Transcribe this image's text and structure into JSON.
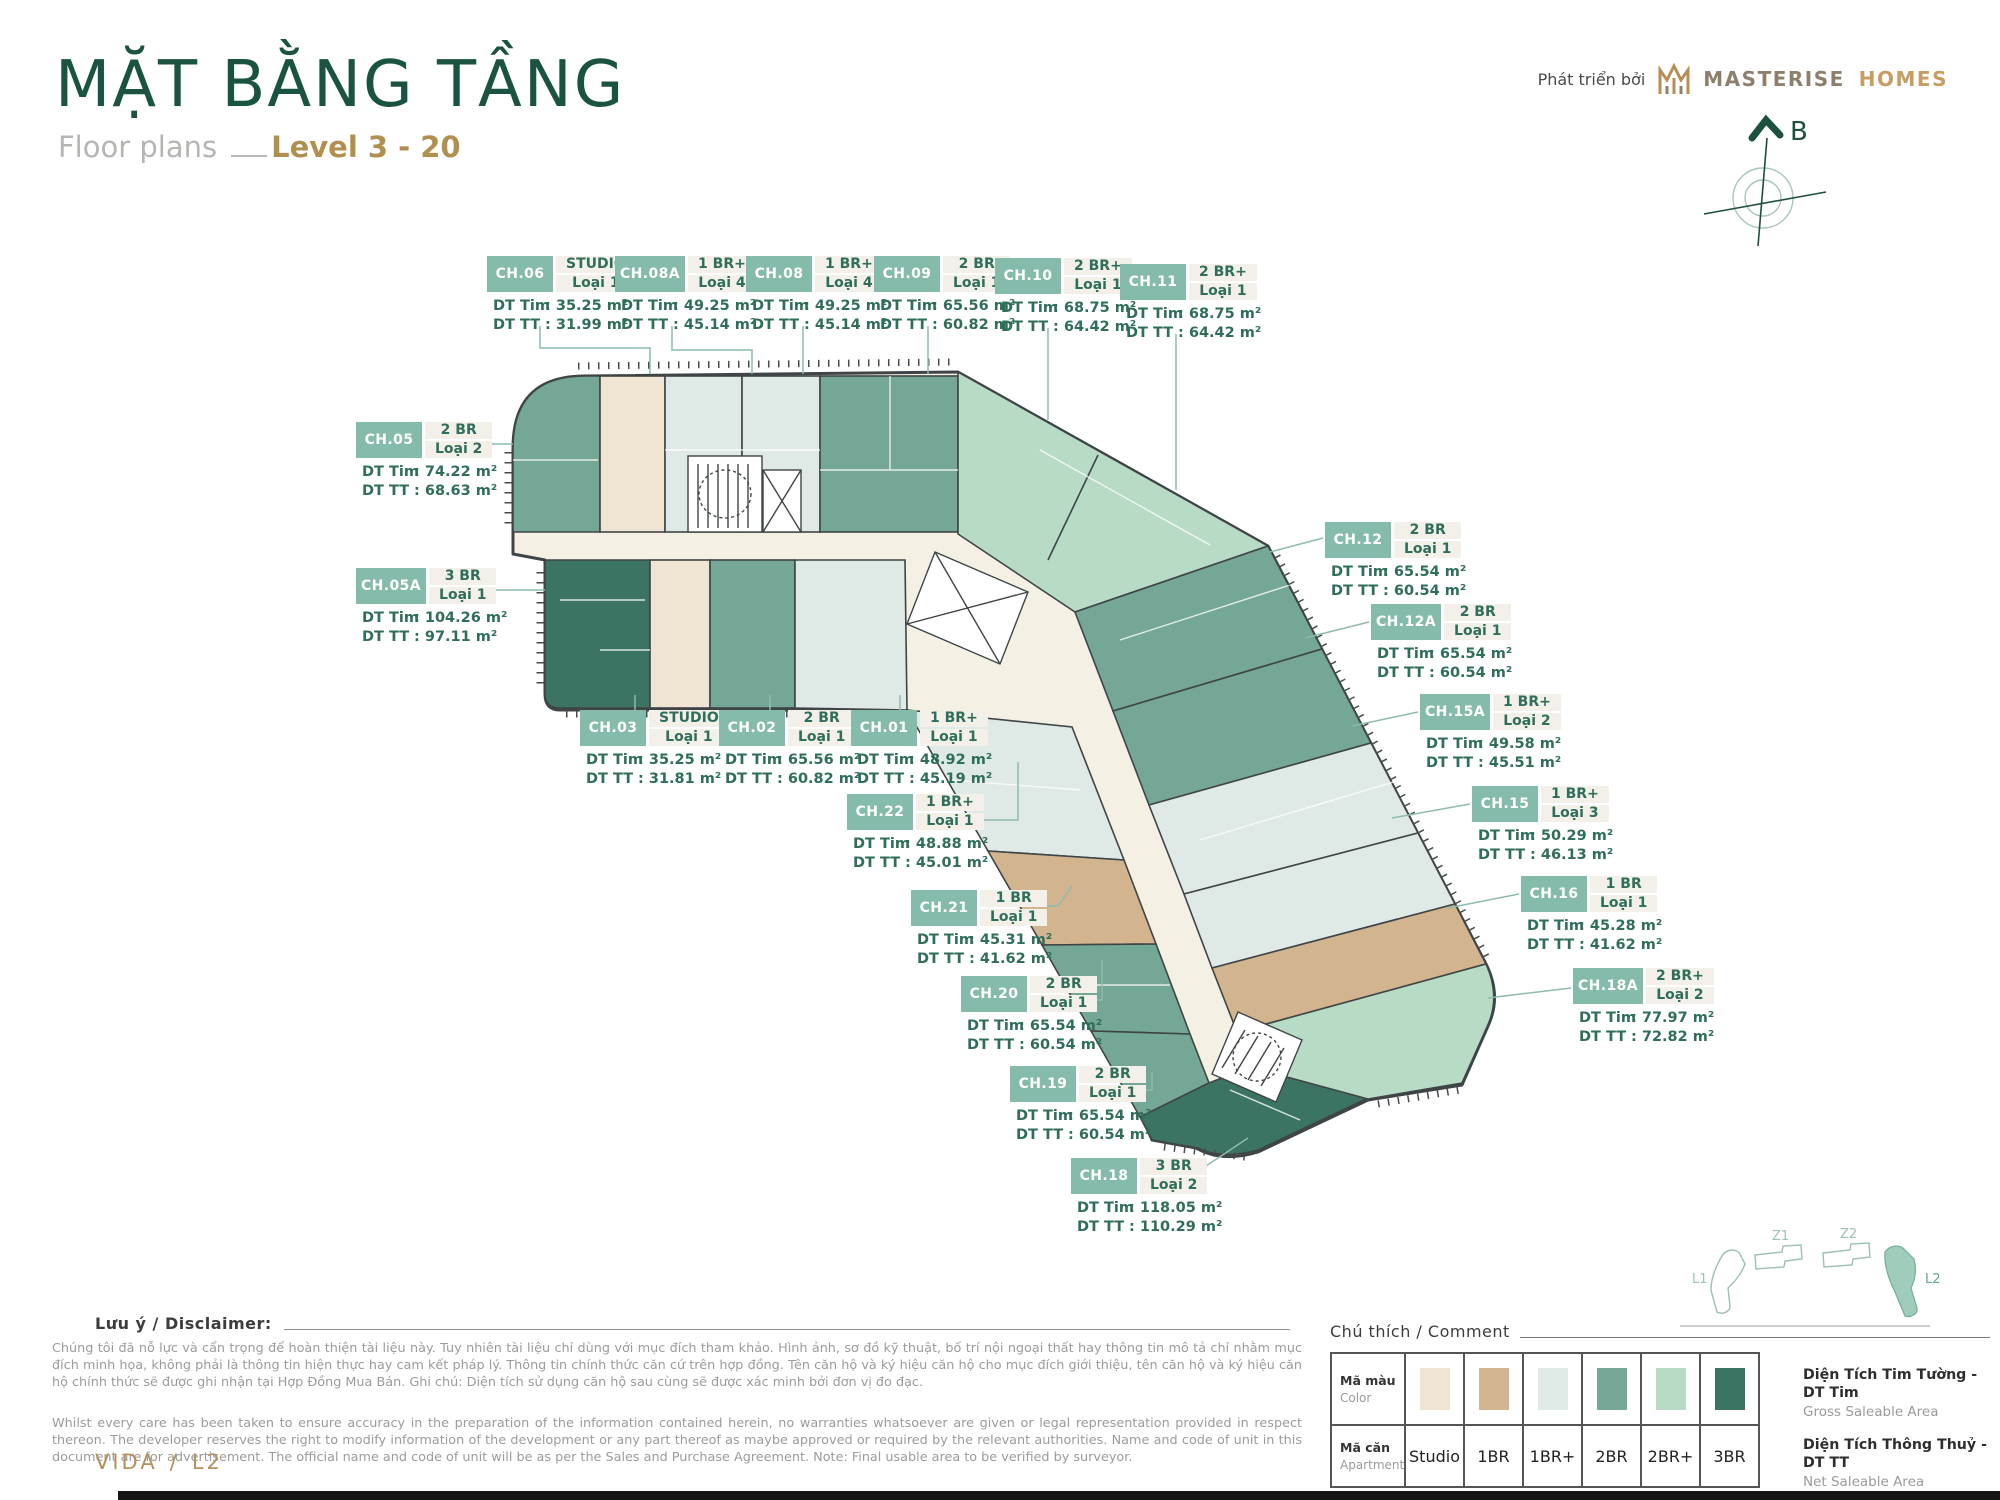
{
  "header": {
    "title": "MẶT BẰNG TẦNG",
    "subtitle": "Floor plans",
    "level": "Level 3 - 20",
    "developer_prefix": "Phát triển bởi",
    "brand": "MASTERISE",
    "brand2": "HOMES",
    "compass_label": "B"
  },
  "plan": {
    "dt_tim_label": "DT Tim",
    "dt_tt_label": "DT TT",
    "units": [
      {
        "id": "CH.06",
        "type": "STUDIO",
        "variant": "Loại 1",
        "dt_tim": "35.25 m²",
        "dt_tt": "31.99 m²"
      },
      {
        "id": "CH.08A",
        "type": "1 BR+",
        "variant": "Loại 4",
        "dt_tim": "49.25 m²",
        "dt_tt": "45.14 m²"
      },
      {
        "id": "CH.08",
        "type": "1 BR+",
        "variant": "Loại 4",
        "dt_tim": "49.25 m²",
        "dt_tt": "45.14 m²"
      },
      {
        "id": "CH.09",
        "type": "2 BR",
        "variant": "Loại 1",
        "dt_tim": "65.56 m²",
        "dt_tt": "60.82 m²"
      },
      {
        "id": "CH.10",
        "type": "2 BR+",
        "variant": "Loại 1",
        "dt_tim": "68.75 m²",
        "dt_tt": "64.42 m²"
      },
      {
        "id": "CH.11",
        "type": "2 BR+",
        "variant": "Loại 1",
        "dt_tim": "68.75 m²",
        "dt_tt": "64.42 m²"
      },
      {
        "id": "CH.05",
        "type": "2 BR",
        "variant": "Loại 2",
        "dt_tim": "74.22 m²",
        "dt_tt": "68.63 m²"
      },
      {
        "id": "CH.05A",
        "type": "3 BR",
        "variant": "Loại 1",
        "dt_tim": "104.26 m²",
        "dt_tt": "97.11 m²"
      },
      {
        "id": "CH.03",
        "type": "STUDIO",
        "variant": "Loại 1",
        "dt_tim": "35.25 m²",
        "dt_tt": "31.81 m²"
      },
      {
        "id": "CH.02",
        "type": "2 BR",
        "variant": "Loại 1",
        "dt_tim": "65.56 m²",
        "dt_tt": "60.82 m²"
      },
      {
        "id": "CH.01",
        "type": "1 BR+",
        "variant": "Loại 1",
        "dt_tim": "48.92 m²",
        "dt_tt": "45.19 m²"
      },
      {
        "id": "CH.22",
        "type": "1 BR+",
        "variant": "Loại 1",
        "dt_tim": "48.88 m²",
        "dt_tt": "45.01 m²"
      },
      {
        "id": "CH.21",
        "type": "1 BR",
        "variant": "Loại 1",
        "dt_tim": "45.31 m²",
        "dt_tt": "41.62 m²"
      },
      {
        "id": "CH.20",
        "type": "2 BR",
        "variant": "Loại 1",
        "dt_tim": "65.54 m²",
        "dt_tt": "60.54 m²"
      },
      {
        "id": "CH.19",
        "type": "2 BR",
        "variant": "Loại 1",
        "dt_tim": "65.54 m²",
        "dt_tt": "60.54 m²"
      },
      {
        "id": "CH.18",
        "type": "3 BR",
        "variant": "Loại 2",
        "dt_tim": "118.05 m²",
        "dt_tt": "110.29 m²"
      },
      {
        "id": "CH.12",
        "type": "2 BR",
        "variant": "Loại 1",
        "dt_tim": "65.54 m²",
        "dt_tt": "60.54 m²"
      },
      {
        "id": "CH.12A",
        "type": "2 BR",
        "variant": "Loại 1",
        "dt_tim": "65.54 m²",
        "dt_tt": "60.54 m²"
      },
      {
        "id": "CH.15A",
        "type": "1 BR+",
        "variant": "Loại 2",
        "dt_tim": "49.58 m²",
        "dt_tt": "45.51 m²"
      },
      {
        "id": "CH.15",
        "type": "1 BR+",
        "variant": "Loại 3",
        "dt_tim": "50.29 m²",
        "dt_tt": "46.13 m²"
      },
      {
        "id": "CH.16",
        "type": "1 BR",
        "variant": "Loại 1",
        "dt_tim": "45.28 m²",
        "dt_tt": "41.62 m²"
      },
      {
        "id": "CH.18A",
        "type": "2 BR+",
        "variant": "Loại 2",
        "dt_tim": "77.97 m²",
        "dt_tt": "72.82 m²"
      }
    ]
  },
  "disclaimer": {
    "heading": "Lưu ý / Disclaimer:",
    "vietnamese": "Chúng tôi đã nỗ lực và cẩn trọng để hoàn thiện tài liệu này. Tuy nhiên tài liệu chỉ dùng với mục đích tham khảo. Hình ảnh, sơ đồ kỹ thuật, bố trí nội ngoại thất hay thông tin mô tả chỉ nhằm mục đích minh họa, không phải là thông tin hiện thực hay cam kết pháp lý. Thông tin chính thức căn cứ trên hợp đồng. Tên căn hộ và ký hiệu căn hộ cho mục đích giới thiệu, tên căn hộ và ký hiệu căn hộ chính thức sẽ được ghi nhận tại Hợp Đồng Mua Bán. Ghi chú: Diện tích sử dụng căn hộ sau cùng sẽ được xác minh bởi đơn vị đo đạc.",
    "english": "Whilst every care has been taken to ensure accuracy in the preparation of the information contained herein, no warranties whatsoever are given or legal representation provided in respect thereon. The developer reserves the right to modify information of the development or any part thereof as maybe approved or required by the relevant authorities. Name and code of unit in this document are for advertisement. The official name and code of unit will be as per the Sales and Purchase Agreement. Note: Final usable area to be verified by surveyor."
  },
  "legend": {
    "heading": "Chú thích / Comment",
    "color_row": {
      "label": "Mã màu",
      "sublabel": "Color"
    },
    "apartment_row": {
      "label": "Mã căn",
      "sublabel": "Apartment"
    },
    "types": [
      {
        "name": "Studio",
        "color": "#f0e4d2"
      },
      {
        "name": "1BR",
        "color": "#d2b48f"
      },
      {
        "name": "1BR+",
        "color": "#dfe9e5"
      },
      {
        "name": "2BR",
        "color": "#74a795"
      },
      {
        "name": "2BR+",
        "color": "#b7dbc4"
      },
      {
        "name": "3BR",
        "color": "#3c7463"
      }
    ],
    "definitions": [
      {
        "vi": "Diện Tích Tim Tường - DT Tim",
        "en": "Gross Saleable Area"
      },
      {
        "vi": "Diện Tích Thông Thuỷ - DT TT",
        "en": "Net Saleable Area"
      }
    ]
  },
  "sitemap": {
    "buildings": [
      {
        "label": "L1"
      },
      {
        "label": "Z1"
      },
      {
        "label": "Z2"
      },
      {
        "label": "L2"
      }
    ],
    "active": "L2"
  },
  "footer": {
    "project": "VIDA",
    "separator": "/",
    "tower": "L2"
  }
}
